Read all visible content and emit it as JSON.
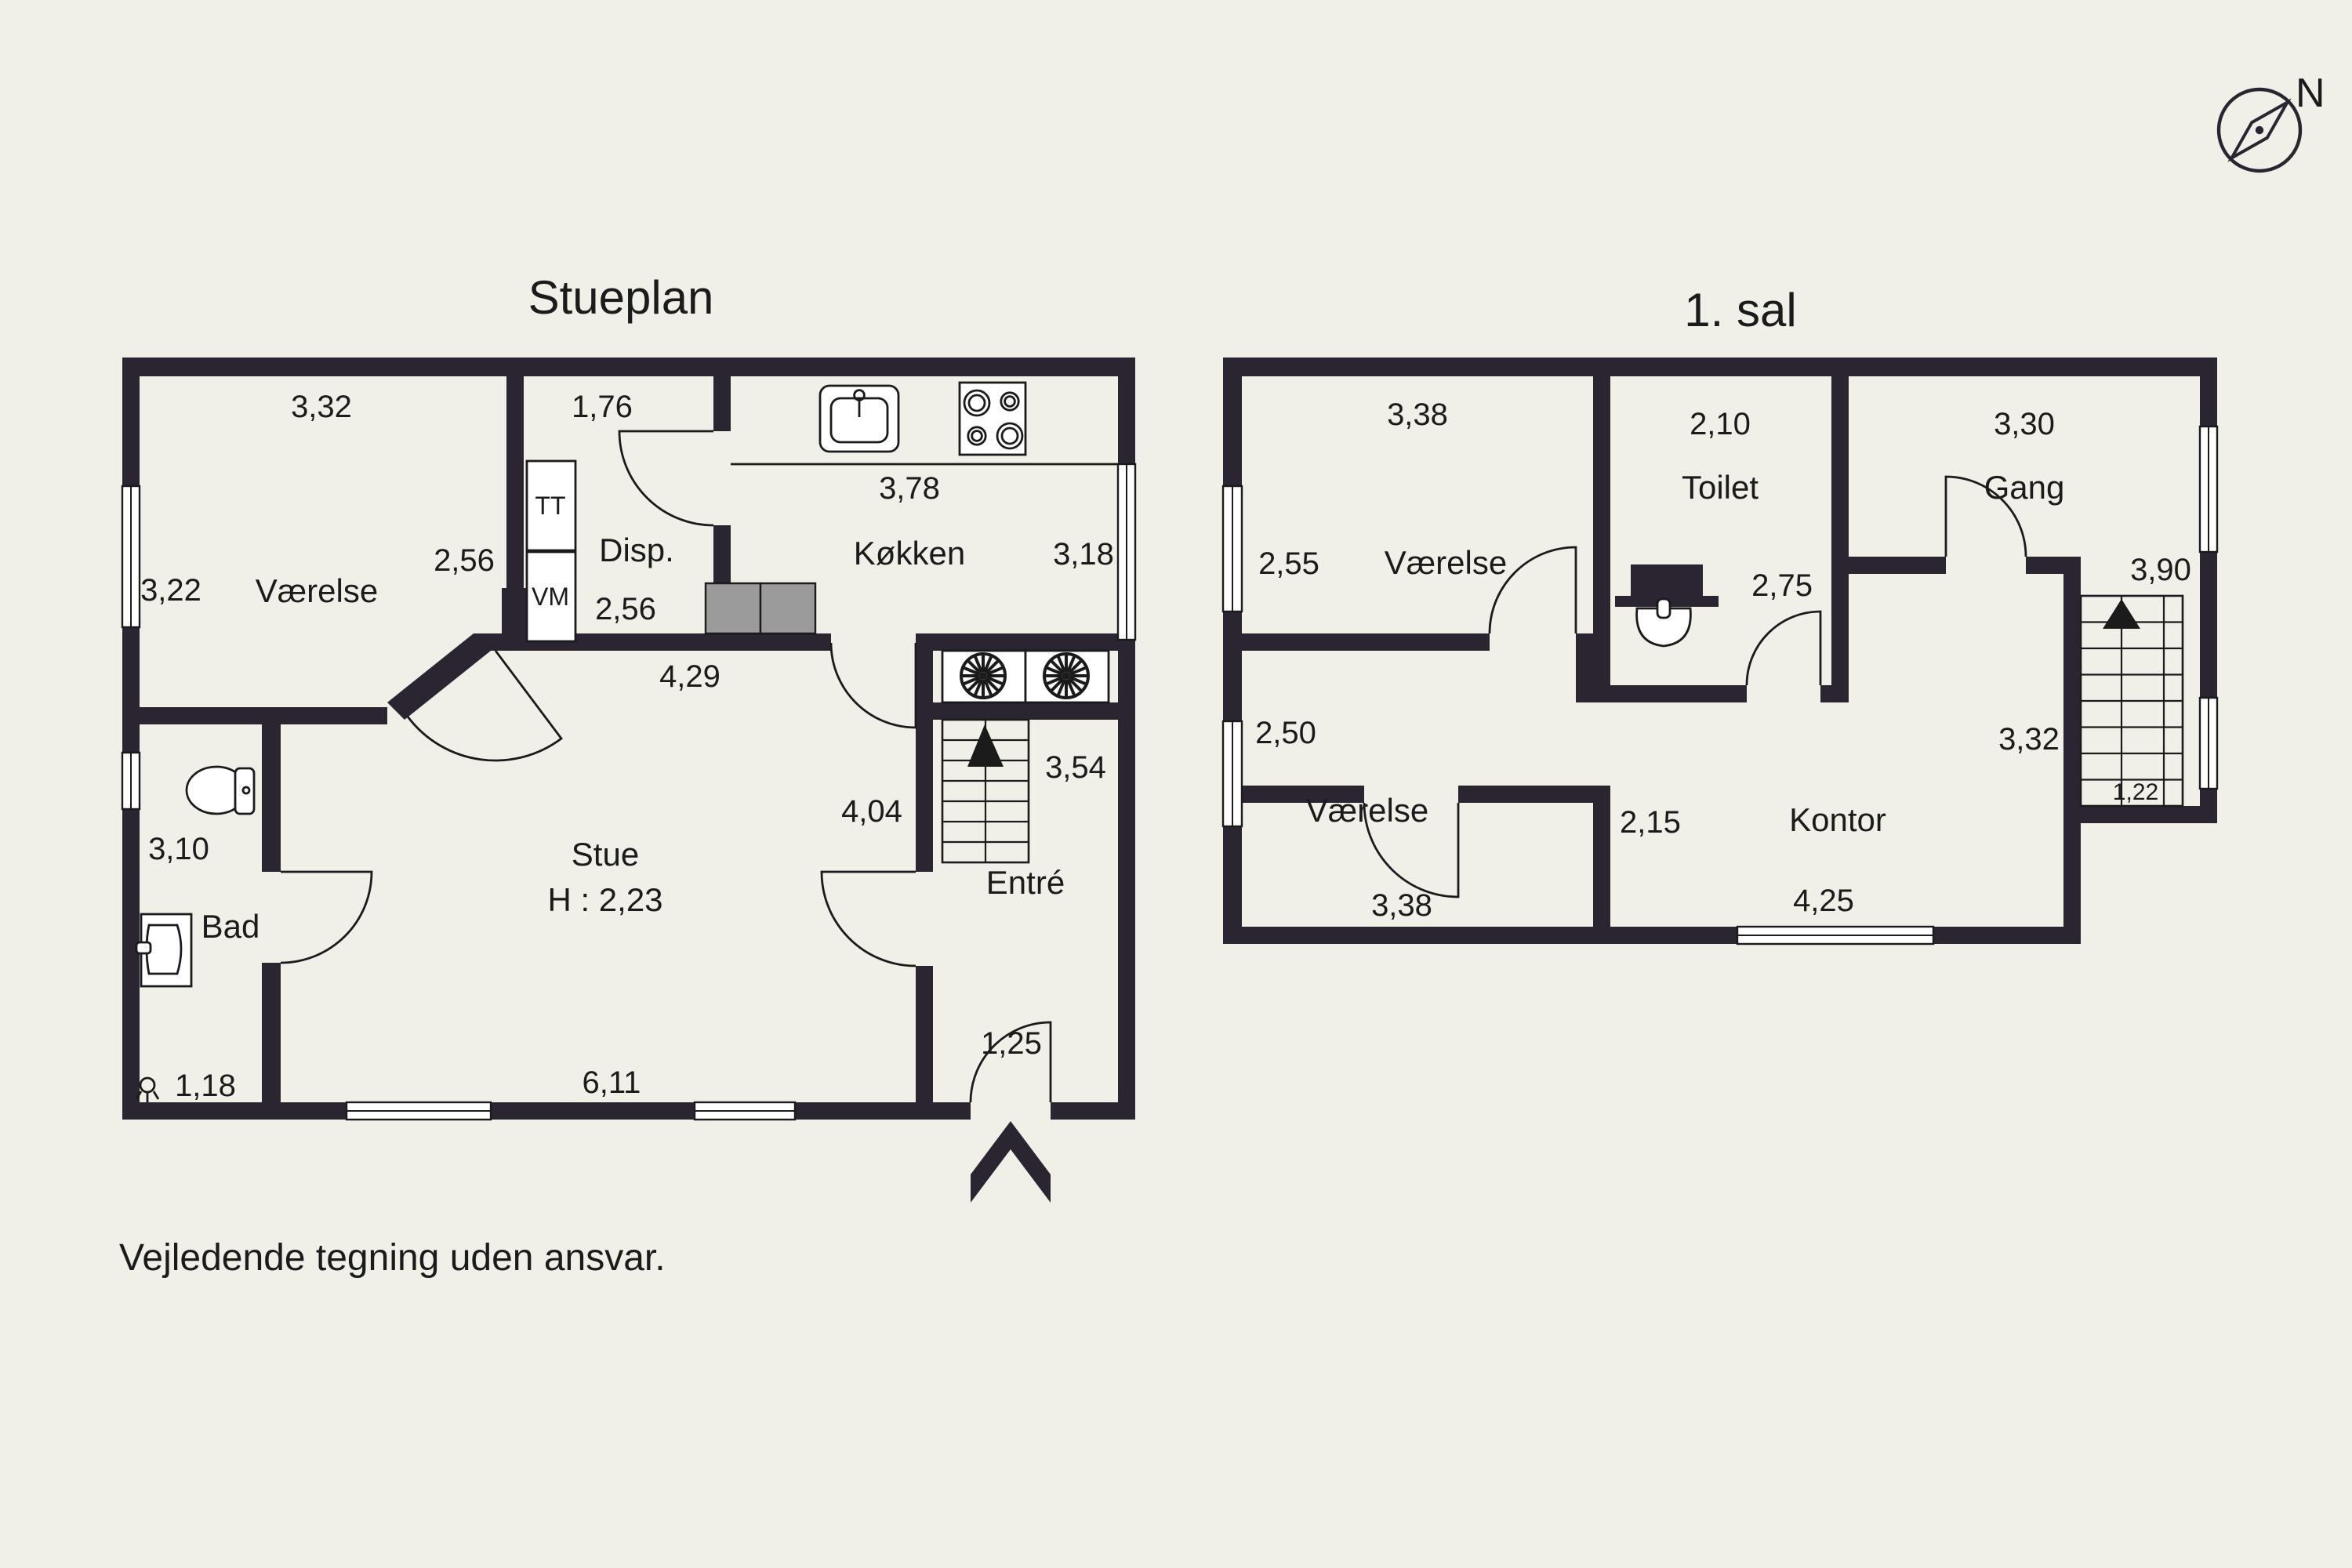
{
  "page": {
    "disclaimer": "Vejledende tegning uden ansvar."
  },
  "compass": {
    "north_label": "N"
  },
  "colors": {
    "background": "#f0efe8",
    "wall": "#2a2531",
    "line": "#1b1b1b",
    "furniture": "#9b9b9b"
  },
  "ground_floor": {
    "title": "Stueplan",
    "rooms": {
      "vaerelse": "Værelse",
      "disp": "Disp.",
      "koekken": "Køkken",
      "stue": "Stue",
      "stue_ceiling_height": "H : 2,23",
      "bad": "Bad",
      "entre": "Entré"
    },
    "appliances": {
      "tumble_dryer": "TT",
      "washing_machine": "VM"
    },
    "dims": {
      "vaerelse_width": "3,32",
      "vaerelse_depth": "3,22",
      "vaerelse_right": "2,56",
      "disp_width": "1,76",
      "koekken_width": "3,78",
      "koekken_right": "3,18",
      "disp_lower": "2,56",
      "stue_upper_width": "4,29",
      "stue_depth": "4,04",
      "entre_depth": "3,54",
      "bad_depth": "3,10",
      "bad_width": "1,18",
      "stue_width": "6,11",
      "entry_door": "1,25"
    }
  },
  "first_floor": {
    "title": "1. sal",
    "rooms": {
      "vaerelse_top": "Værelse",
      "toilet": "Toilet",
      "gang": "Gang",
      "vaerelse_bottom": "Værelse",
      "kontor": "Kontor"
    },
    "dims": {
      "vaerelse_top_width": "3,38",
      "vaerelse_top_left": "2,55",
      "toilet_width": "2,10",
      "gang_width": "3,30",
      "toilet_depth": "2,75",
      "stairs_top": "3,90",
      "vaerelse_bottom_left": "2,50",
      "kontor_left": "2,15",
      "stairs_left": "3,32",
      "stairs_width": "1,22",
      "vaerelse_bottom_width": "3,38",
      "kontor_width": "4,25"
    }
  }
}
